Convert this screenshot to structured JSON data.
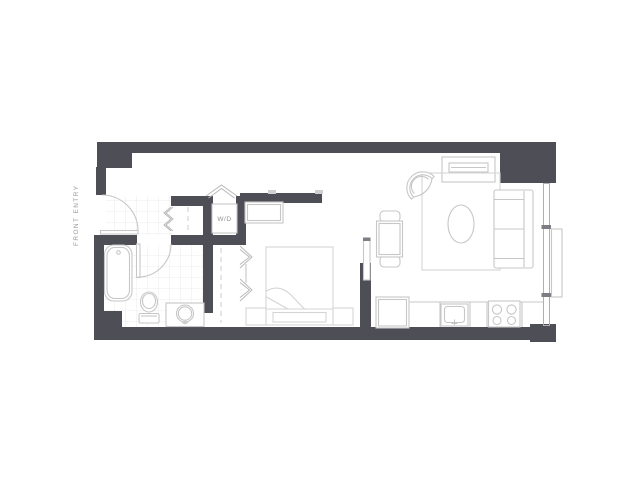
{
  "floor_plan": {
    "labels": {
      "front_entry": "FRONT ENTRY",
      "washer_dryer": "W/D"
    },
    "colors": {
      "wall": "#4e4e56",
      "fixture_line": "#c7c7c7",
      "soft_furniture_line": "#d4d4d4",
      "window_line": "#b0b0b0",
      "door_jamb": "#7d7d85",
      "tile_line": "#e7e7e7",
      "label_text": "#9a9a9a",
      "background": "#ffffff"
    }
  }
}
